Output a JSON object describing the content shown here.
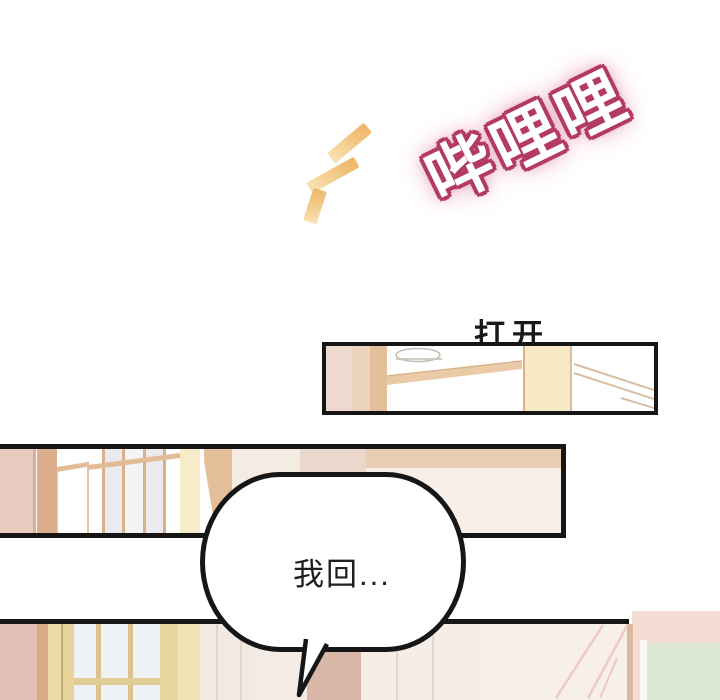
{
  "page": {
    "background": "#ffffff"
  },
  "sfx": {
    "text": "哔哩哩"
  },
  "caption": {
    "text": "打开"
  },
  "bubble": {
    "text": "我回..."
  },
  "colors": {
    "ink": "#161616",
    "sfx_outline": "#b23a63",
    "sfx_glow": "#e596b1",
    "dash_dark": "#efba6e",
    "dash_light": "#f8dfad",
    "p1_pink1": "#edd9ce",
    "p1_pink2": "#ecd3bd",
    "p1_tan": "#e4bd99",
    "p1_beam": "#ebcba7",
    "p1_beam_edge": "#d9b28a",
    "p1_paleyellow": "#f7e9c3",
    "p1_corner": "#d8bfa3",
    "p1_light_outline": "#c6beb4",
    "p2_pink": "#e8cabf",
    "p2_pink_edge": "#d8ae9c",
    "p2_tancol": "#dcae8c",
    "p2_doortan": "#e2bc96",
    "p2_glass1": "#eaeaef",
    "p2_glass2": "#f4f4f7",
    "p2_divider": "#d9b088",
    "p2_py": "#f6ecc8",
    "p2_shade": "#e3be98",
    "p2_ow": "#f4ebe2",
    "p2_pinkgray": "#ead8cc",
    "p2_tanstrip": "#e9cdb3",
    "p2_ow2": "#f7efe8",
    "p3_pink": "#e2c0b5",
    "p3_tan": "#d9a988",
    "p3_py1": "#ebdca6",
    "p3_dark": "#c9a87e",
    "p3_py2": "#e6d49a",
    "p3_glass": "#eff2f4",
    "p3_muntin": "#d9c28e",
    "p3_rail": "#e2cd96",
    "p3_stile": "#e8d8a0",
    "p3_py3": "#f0e4b4",
    "p3_ow1": "#f2eae2",
    "p3_line": "#e3d7cb",
    "p3_ow2": "#f4ece4",
    "p3_mauve": "#d8b7a8",
    "p3_ow3": "#f5ede6",
    "p3_ow4": "#f7f0e9",
    "p3_diag": "#efc9c2",
    "p3_frame": "#d9ba9c",
    "p3_pinkr": "#f2dcd3",
    "p3_wframe": "#faf6f1",
    "p3_green": "#dae8d4"
  }
}
